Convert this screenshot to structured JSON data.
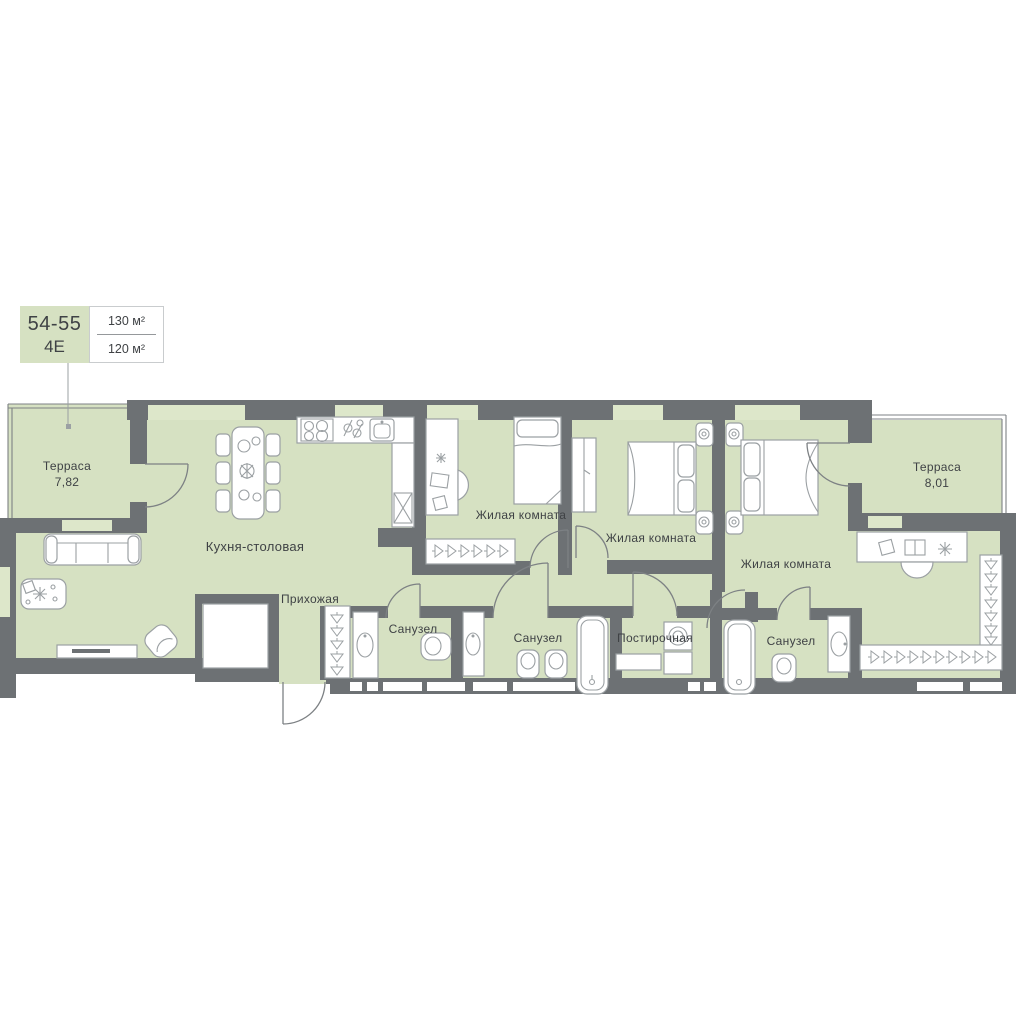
{
  "unit_card": {
    "number": "54-55",
    "type": "4Е",
    "area_total": "130 м²",
    "area_living": "120 м²"
  },
  "rooms": [
    {
      "id": "terrace-left",
      "label": "Терраса",
      "area": "7,82"
    },
    {
      "id": "kitchen-dining",
      "label": "Кухня-столовая"
    },
    {
      "id": "hallway",
      "label": "Прихожая"
    },
    {
      "id": "living-1",
      "label": "Жилая комната"
    },
    {
      "id": "living-2",
      "label": "Жилая комната"
    },
    {
      "id": "living-3",
      "label": "Жилая комната"
    },
    {
      "id": "bathroom-1",
      "label": "Санузел"
    },
    {
      "id": "bathroom-2",
      "label": "Санузел"
    },
    {
      "id": "laundry",
      "label": "Постирочная"
    },
    {
      "id": "bathroom-3",
      "label": "Санузел"
    },
    {
      "id": "terrace-right",
      "label": "Терраса",
      "area": "8,01"
    }
  ],
  "palette": {
    "room_fill": "#d6e1c2",
    "window_fill": "#dde7ca",
    "wall": "#6d7174",
    "furniture_stroke": "#9ba0a3",
    "door_stroke": "#7d8184",
    "text": "#3f4245",
    "card_border": "#c9ccce"
  }
}
